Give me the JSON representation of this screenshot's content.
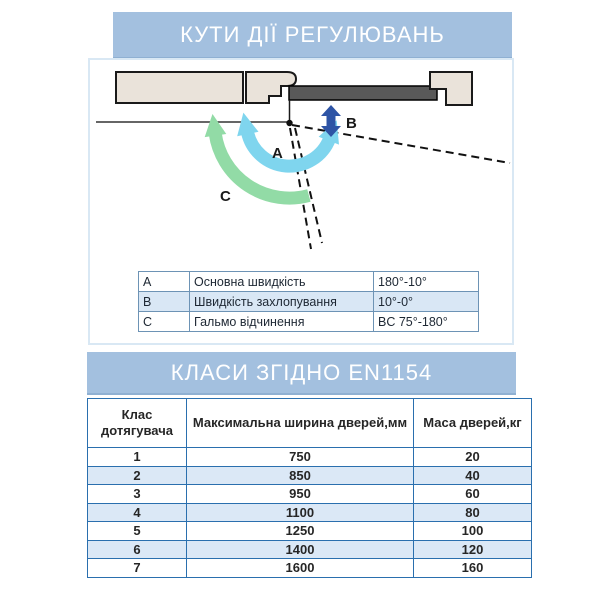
{
  "section_angles": {
    "title": "КУТИ ДІЇ РЕГУЛЮВАНЬ",
    "diagram": {
      "label_a": "A",
      "label_b": "B",
      "label_c": "C"
    },
    "legend": {
      "rows": [
        {
          "key": "A",
          "name": "Основна швидкість",
          "value": "180°-10°"
        },
        {
          "key": "B",
          "name": "Швидкість захлопування",
          "value": "10°-0°"
        },
        {
          "key": "C",
          "name": "Гальмо відчинення",
          "value": "BC 75°-180°"
        }
      ]
    }
  },
  "section_classes": {
    "title": "КЛАСИ ЗГІДНО EN1154",
    "table": {
      "headers": [
        "Клас дотягувача",
        "Максимальна ширина дверей,мм",
        "Маса дверей,кг"
      ],
      "rows": [
        [
          "1",
          "750",
          "20"
        ],
        [
          "2",
          "850",
          "40"
        ],
        [
          "3",
          "950",
          "60"
        ],
        [
          "4",
          "1100",
          "80"
        ],
        [
          "5",
          "1250",
          "100"
        ],
        [
          "6",
          "1400",
          "120"
        ],
        [
          "7",
          "1600",
          "160"
        ]
      ]
    }
  },
  "colors": {
    "banner_bg": "#a3c0df",
    "banner_text": "#ffffff",
    "diagram_border": "#d9e8f4",
    "wall_fill": "#eae3da",
    "door_fill": "#595959",
    "arc_a": "#7fd5ee",
    "arc_c": "#92dba6",
    "arrow_b": "#2e54a5",
    "legend_alt_row": "#d9e7f5",
    "classes_border": "#2a6fae",
    "classes_alt_row": "#dbe8f6"
  }
}
